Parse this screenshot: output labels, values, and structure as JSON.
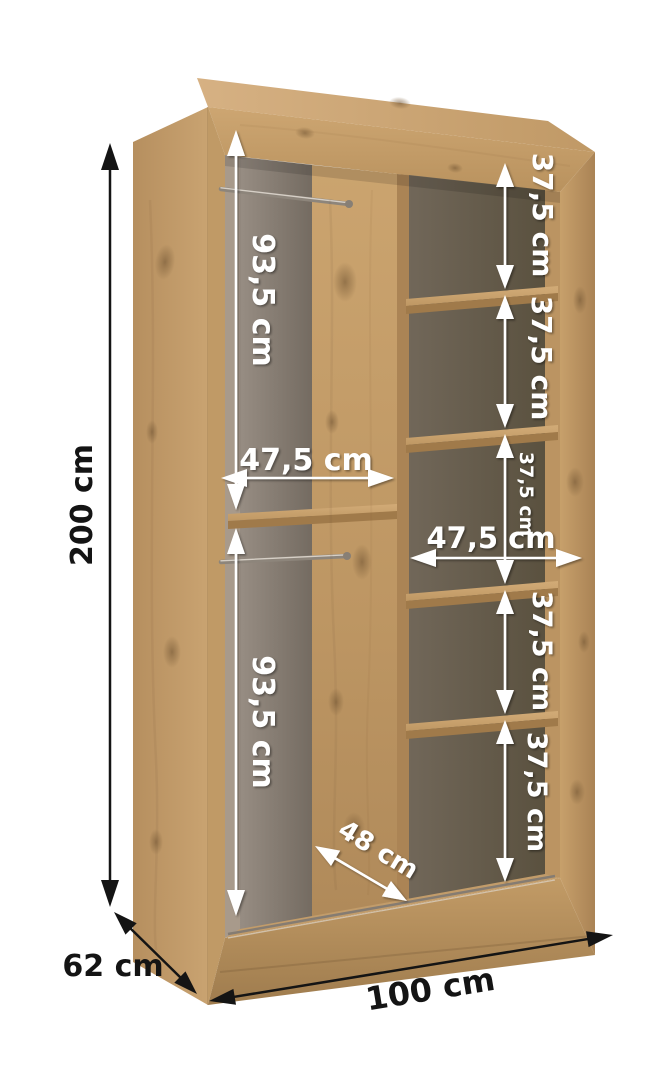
{
  "figure": {
    "type": "furniture-dimension-diagram",
    "subject": "open two-section wardrobe carcass with shelves and hanging rails, 3d product render",
    "background": "#ffffff"
  },
  "colors": {
    "wood_light": "#cfa977",
    "wood_mid": "#c39c68",
    "wood_dark": "#a9845a",
    "interior_left_back": "#8f867d",
    "interior_right_back": "#675e53",
    "rail_metal": "#9c948a",
    "annotation_white": "#ffffff",
    "annotation_black": "#141414"
  },
  "annotations": {
    "overall": {
      "height": "200 cm",
      "depth": "62 cm",
      "width": "100 cm"
    },
    "left_column": {
      "top_height": "93,5 cm",
      "bottom_height": "93,5 cm",
      "width": "47,5 cm"
    },
    "right_column": {
      "width": "47,5 cm",
      "shelf_gaps": [
        "37,5 cm",
        "37,5 cm",
        "37,5 cm",
        "37,5 cm",
        "37,5 cm"
      ]
    },
    "internal_depth": "48 cm"
  }
}
